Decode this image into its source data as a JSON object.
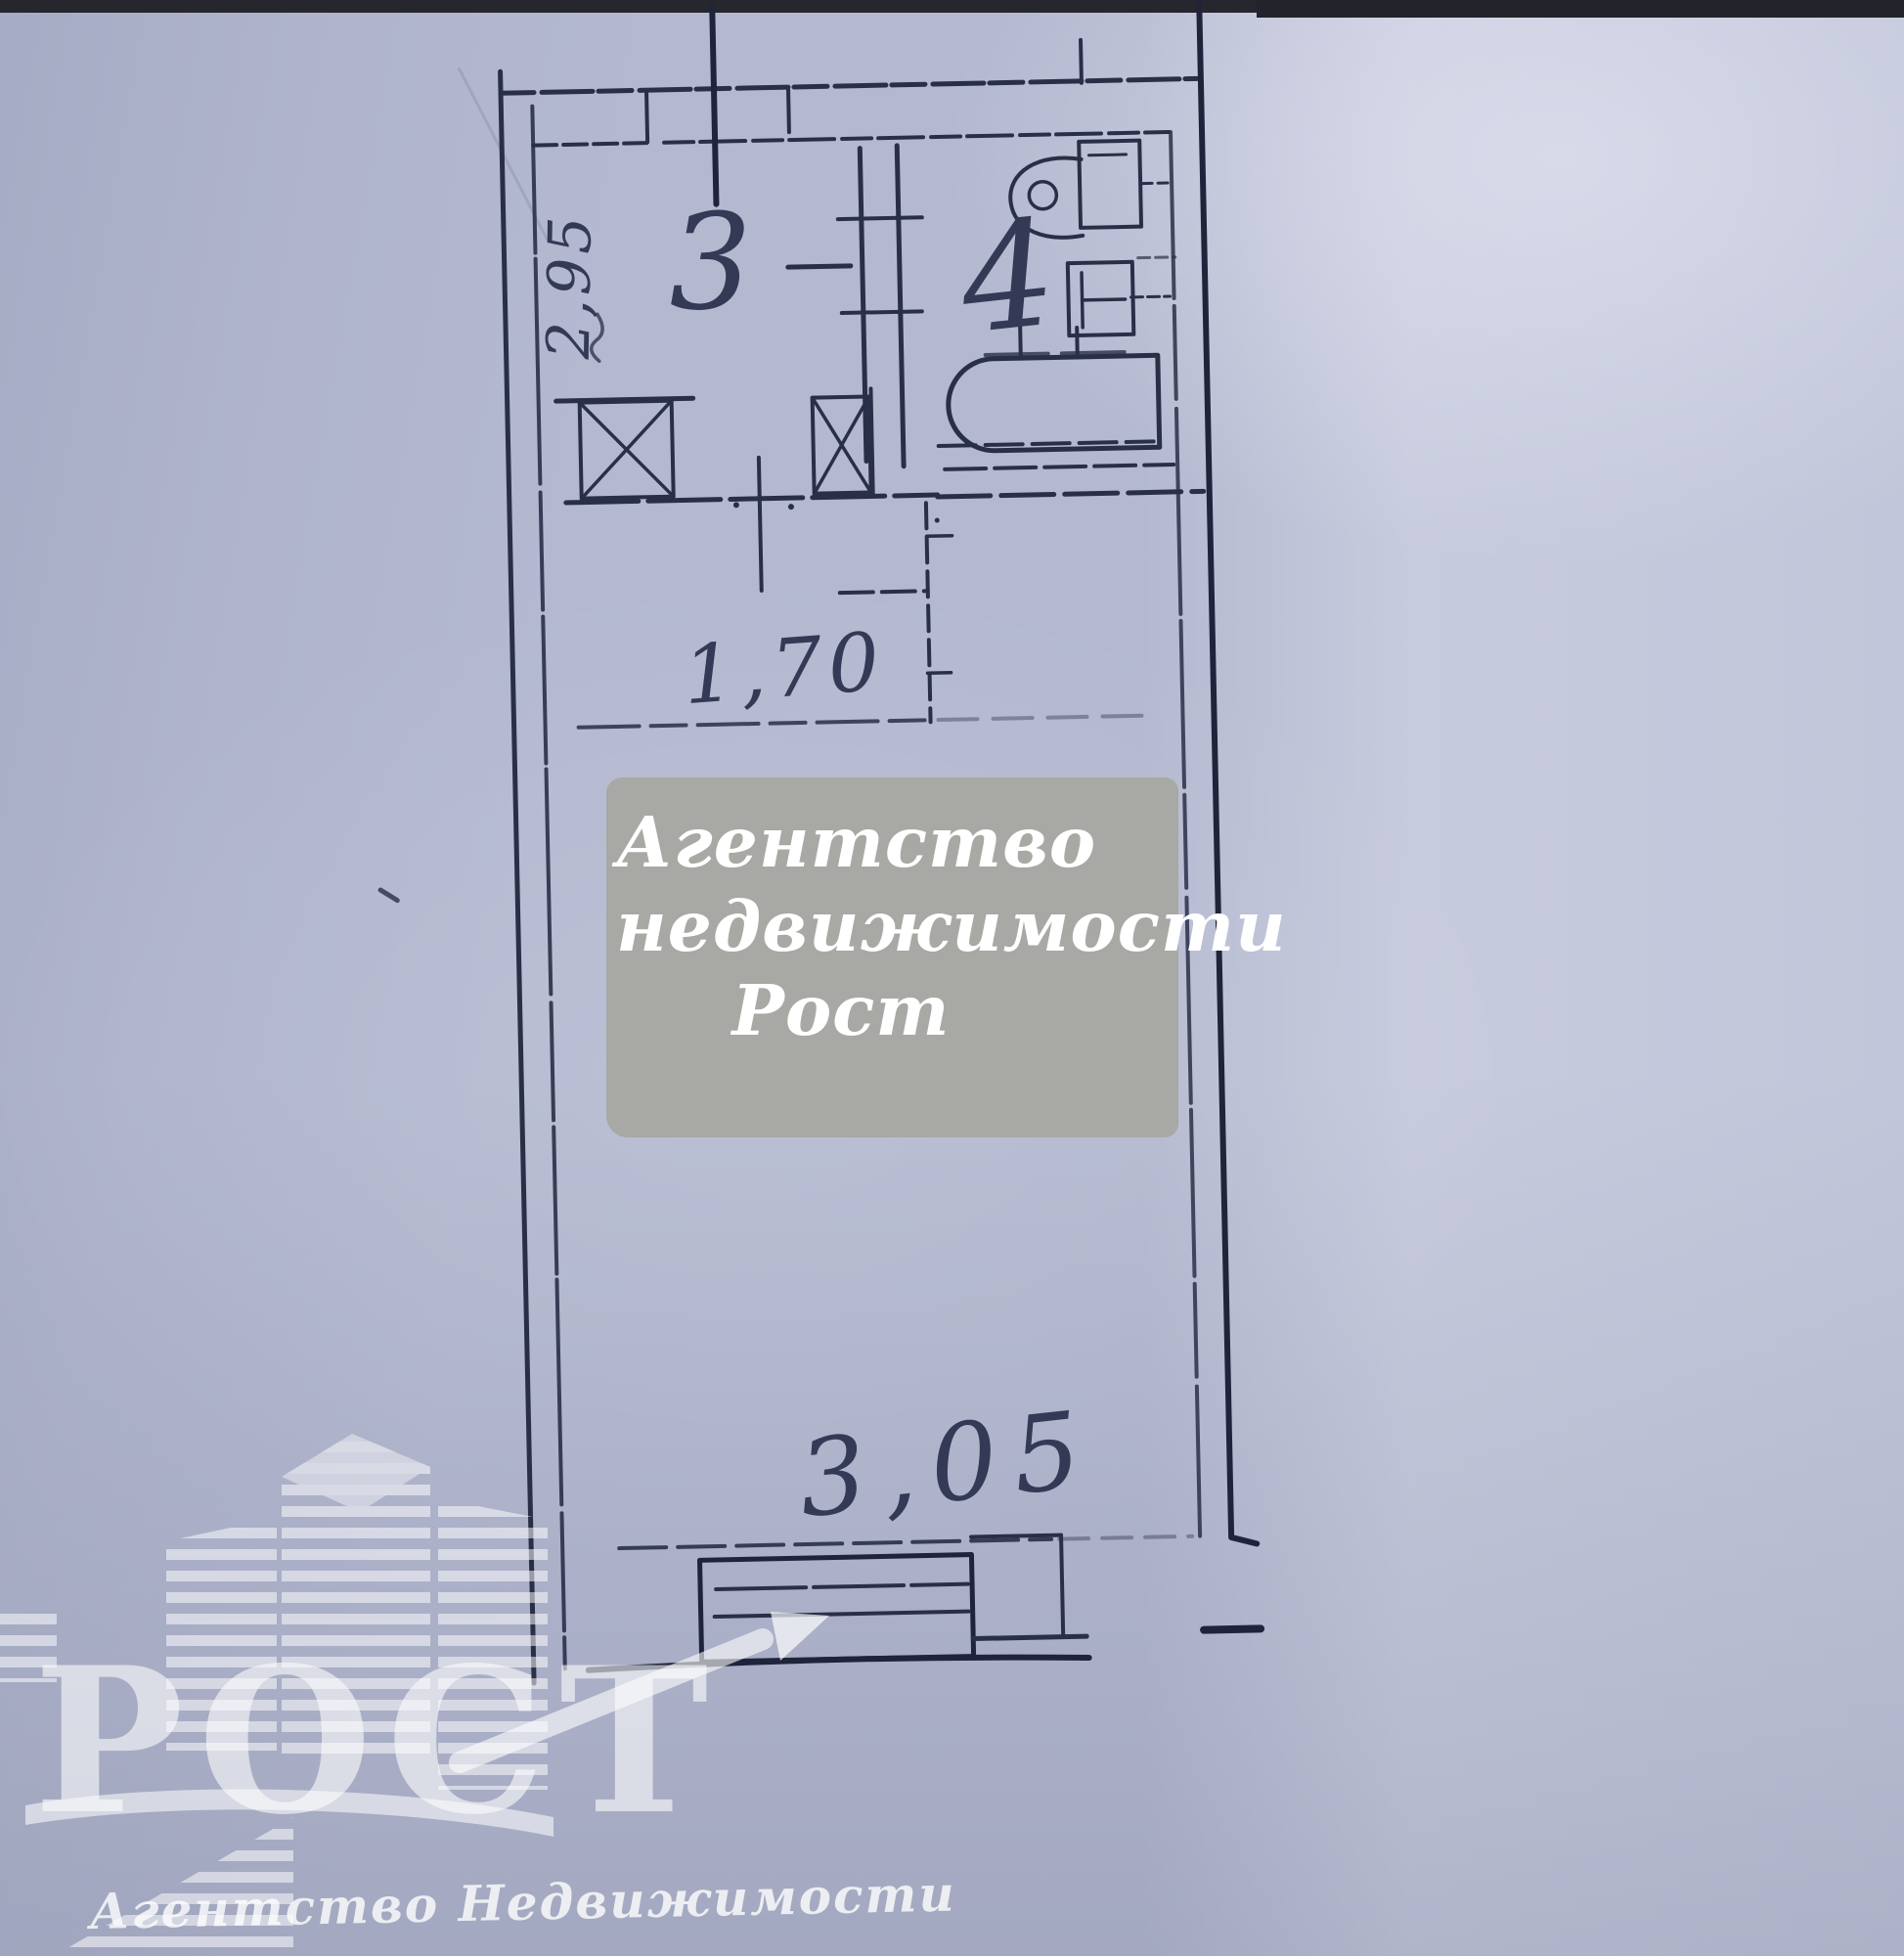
{
  "colors": {
    "paper": "#b4b9d0",
    "ink": "#2a2f48",
    "ink_dark": "#20243a",
    "handwriting": "#343a55",
    "top_strip": "#26262e",
    "watermark_box_bg": "#a8a8a4",
    "watermark_text": "#ffffff",
    "logo_white": "#ffffff"
  },
  "plan": {
    "dimensions": {
      "hall_width": "2,95",
      "hallway_length": "1,70",
      "room_width": "3,05"
    },
    "rooms": {
      "room3_label": "3",
      "room4_label": "4"
    },
    "fixture_icons": [
      "toilet-icon",
      "sink-icon",
      "bathtub-icon",
      "vent-shaft-icon",
      "vent-shaft-icon",
      "window-icon",
      "balcony-door-icon"
    ]
  },
  "watermark_box": {
    "lines": [
      "Агентство",
      "недвижимости",
      "Рост"
    ]
  },
  "logo": {
    "title": "РОСТ",
    "subtitle": "Агентство Недвижимости"
  }
}
